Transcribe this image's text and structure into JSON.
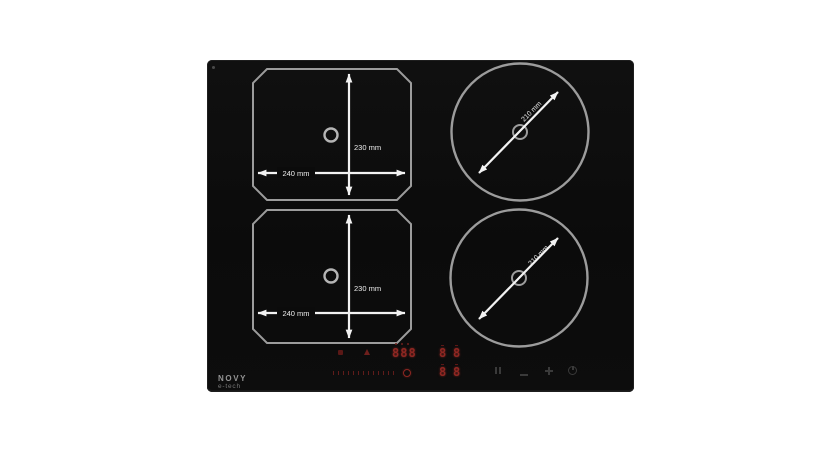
{
  "product": {
    "brand": "NOVY",
    "brand_line2": "e-tech"
  },
  "zones": {
    "flex_top_left": {
      "width_label": "240 mm",
      "height_label": "230 mm"
    },
    "flex_bottom_left": {
      "width_label": "240 mm",
      "height_label": "230 mm"
    },
    "round_top_right": {
      "diameter_label": "210 mm"
    },
    "round_bottom_right": {
      "diameter_label": "210 mm"
    }
  },
  "control_panel": {
    "timer_display": "888",
    "zone_displays": [
      "8",
      "8",
      "8",
      "8"
    ],
    "led_color": "#8f2722",
    "touch_icon_color": "#3a3a3a"
  },
  "colors": {
    "hob_surface": "#0c0c0c",
    "zone_outline": "#9c9c9c",
    "dimension_marking": "#f2f2f2",
    "background": "#ffffff"
  }
}
